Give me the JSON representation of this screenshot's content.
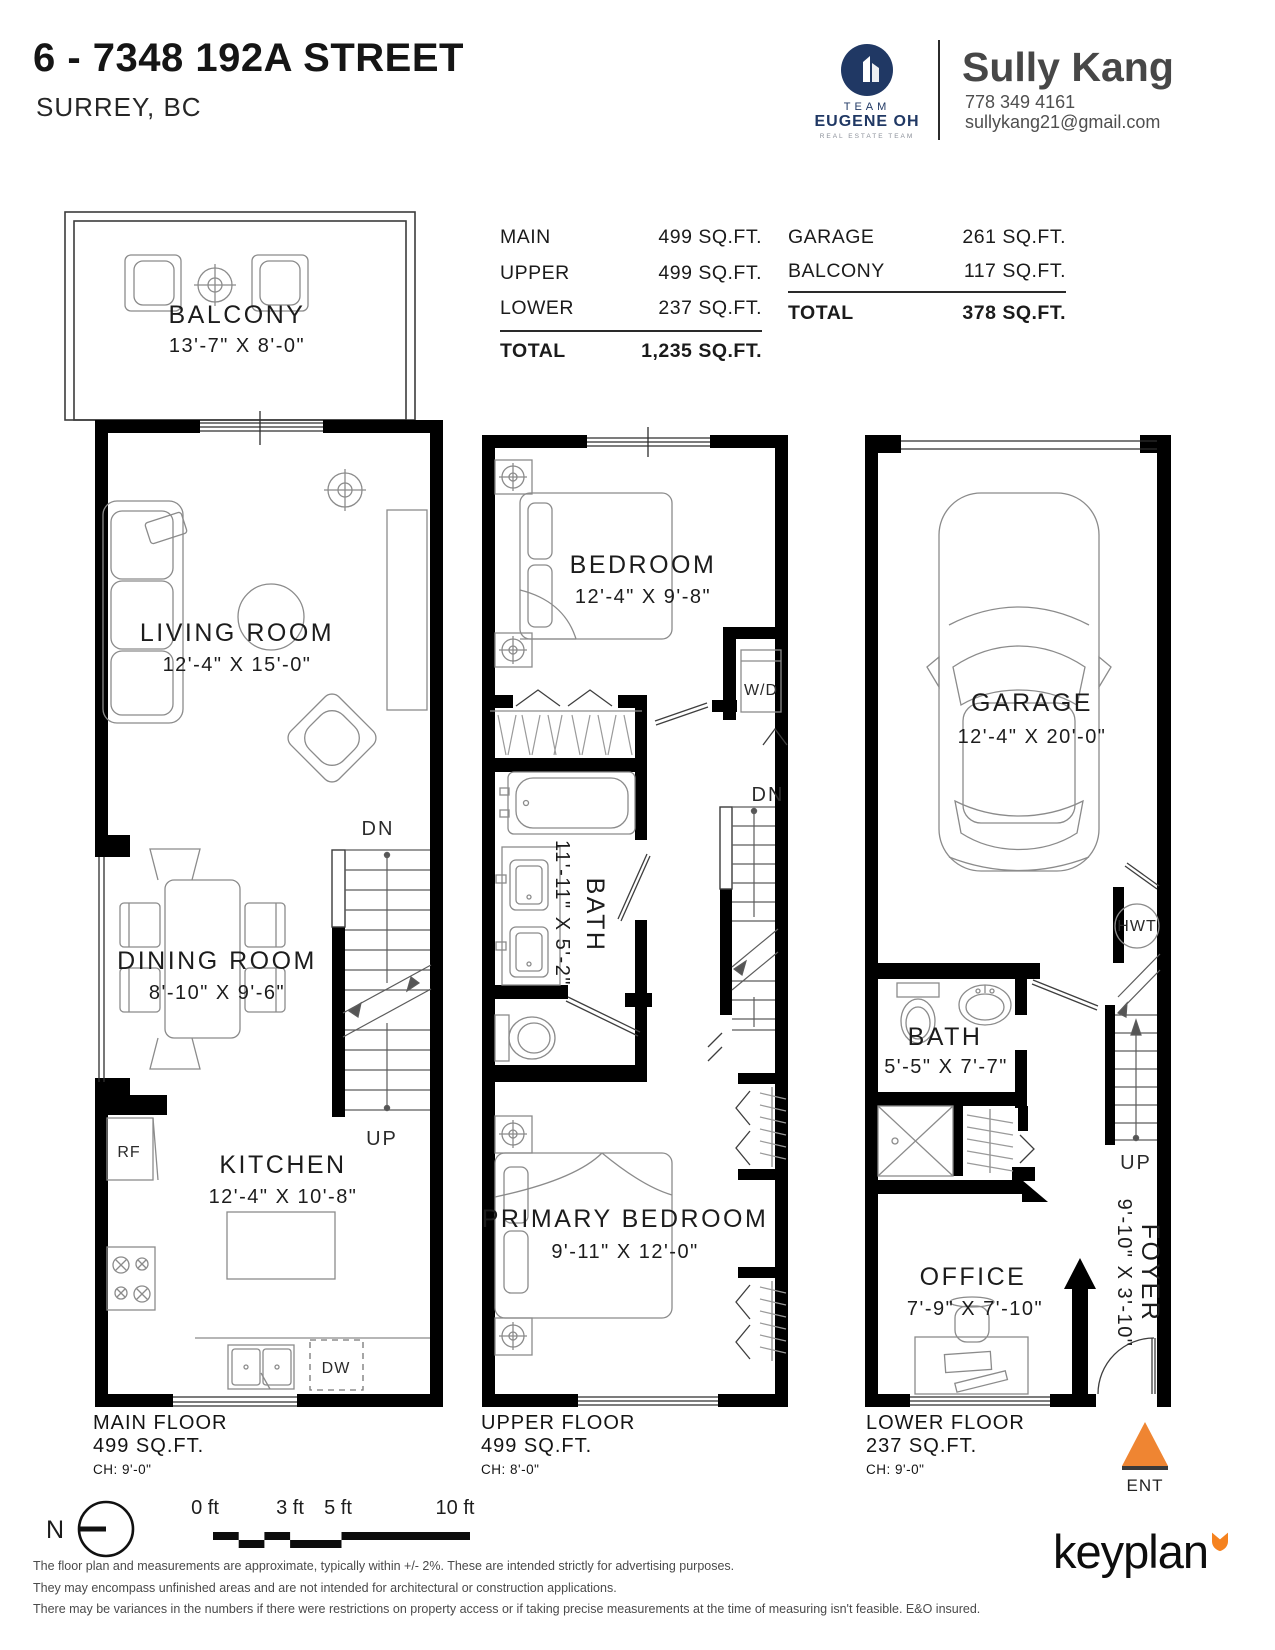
{
  "header": {
    "title": "6 - 7348 192A STREET",
    "subtitle": "SURREY, BC",
    "brand": {
      "team": "TEAM",
      "name": "EUGENE OH",
      "tagline": "REAL ESTATE TEAM"
    },
    "agent": {
      "name": "Sully Kang",
      "phone": "778 349 4161",
      "email": "sullykang21@gmail.com"
    }
  },
  "area_tables": {
    "left": {
      "rows": [
        {
          "label": "MAIN",
          "value": "499 SQ.FT."
        },
        {
          "label": "UPPER",
          "value": "499 SQ.FT."
        },
        {
          "label": "LOWER",
          "value": "237 SQ.FT."
        }
      ],
      "total": {
        "label": "TOTAL",
        "value": "1,235 SQ.FT."
      }
    },
    "right": {
      "rows": [
        {
          "label": "GARAGE",
          "value": "261 SQ.FT."
        },
        {
          "label": "BALCONY",
          "value": "117 SQ.FT."
        }
      ],
      "total": {
        "label": "TOTAL",
        "value": "378 SQ.FT."
      }
    }
  },
  "floors": {
    "main": {
      "name": "MAIN FLOOR",
      "area": "499 SQ.FT.",
      "ceiling": "CH: 9'-0\"",
      "rooms": {
        "balcony": {
          "label": "BALCONY",
          "dims": "13'-7\" X 8'-0\""
        },
        "living": {
          "label": "LIVING ROOM",
          "dims": "12'-4\" X 15'-0\""
        },
        "dining": {
          "label": "DINING ROOM",
          "dims": "8'-10\" X 9'-6\""
        },
        "kitchen": {
          "label": "KITCHEN",
          "dims": "12'-4\" X 10'-8\""
        }
      },
      "labels": {
        "dn": "DN",
        "up": "UP",
        "rf": "RF",
        "dw": "DW"
      }
    },
    "upper": {
      "name": "UPPER FLOOR",
      "area": "499 SQ.FT.",
      "ceiling": "CH: 8'-0\"",
      "rooms": {
        "bedroom": {
          "label": "BEDROOM",
          "dims": "12'-4\" X 9'-8\""
        },
        "bath": {
          "label": "BATH",
          "dims": "11'-11\" X 5'-2\""
        },
        "primary": {
          "label": "PRIMARY BEDROOM",
          "dims": "9'-11\" X 12'-0\""
        }
      },
      "labels": {
        "wd": "W/D",
        "dn": "DN"
      }
    },
    "lower": {
      "name": "LOWER FLOOR",
      "area": "237 SQ.FT.",
      "ceiling": "CH: 9'-0\"",
      "rooms": {
        "garage": {
          "label": "GARAGE",
          "dims": "12'-4\" X 20'-0\""
        },
        "bath": {
          "label": "BATH",
          "dims": "5'-5\" X 7'-7\""
        },
        "office": {
          "label": "OFFICE",
          "dims": "7'-9\" X 7'-10\""
        },
        "foyer": {
          "label": "FOYER",
          "dims": "9'-10\" X 3'-10\""
        }
      },
      "labels": {
        "hwt": "HWT",
        "up": "UP",
        "ent": "ENT"
      }
    }
  },
  "footer": {
    "north_label": "N",
    "scale": {
      "ticks": [
        "0 ft",
        "3 ft",
        "5 ft",
        "10 ft"
      ]
    },
    "disclaimer": [
      "The floor plan and measurements are approximate, typically within +/- 2%. These are intended strictly for advertising purposes.",
      "They may encompass unfinished areas and are not intended for architectural or construction applications.",
      "There may be variances in the numbers if there were restrictions on property access or if taking precise measurements at the time of measuring isn't feasible. E&O insured."
    ],
    "brand": "keyplan"
  },
  "colors": {
    "accent_orange": "#ef8532",
    "navy": "#203864",
    "wall": "#000000"
  }
}
